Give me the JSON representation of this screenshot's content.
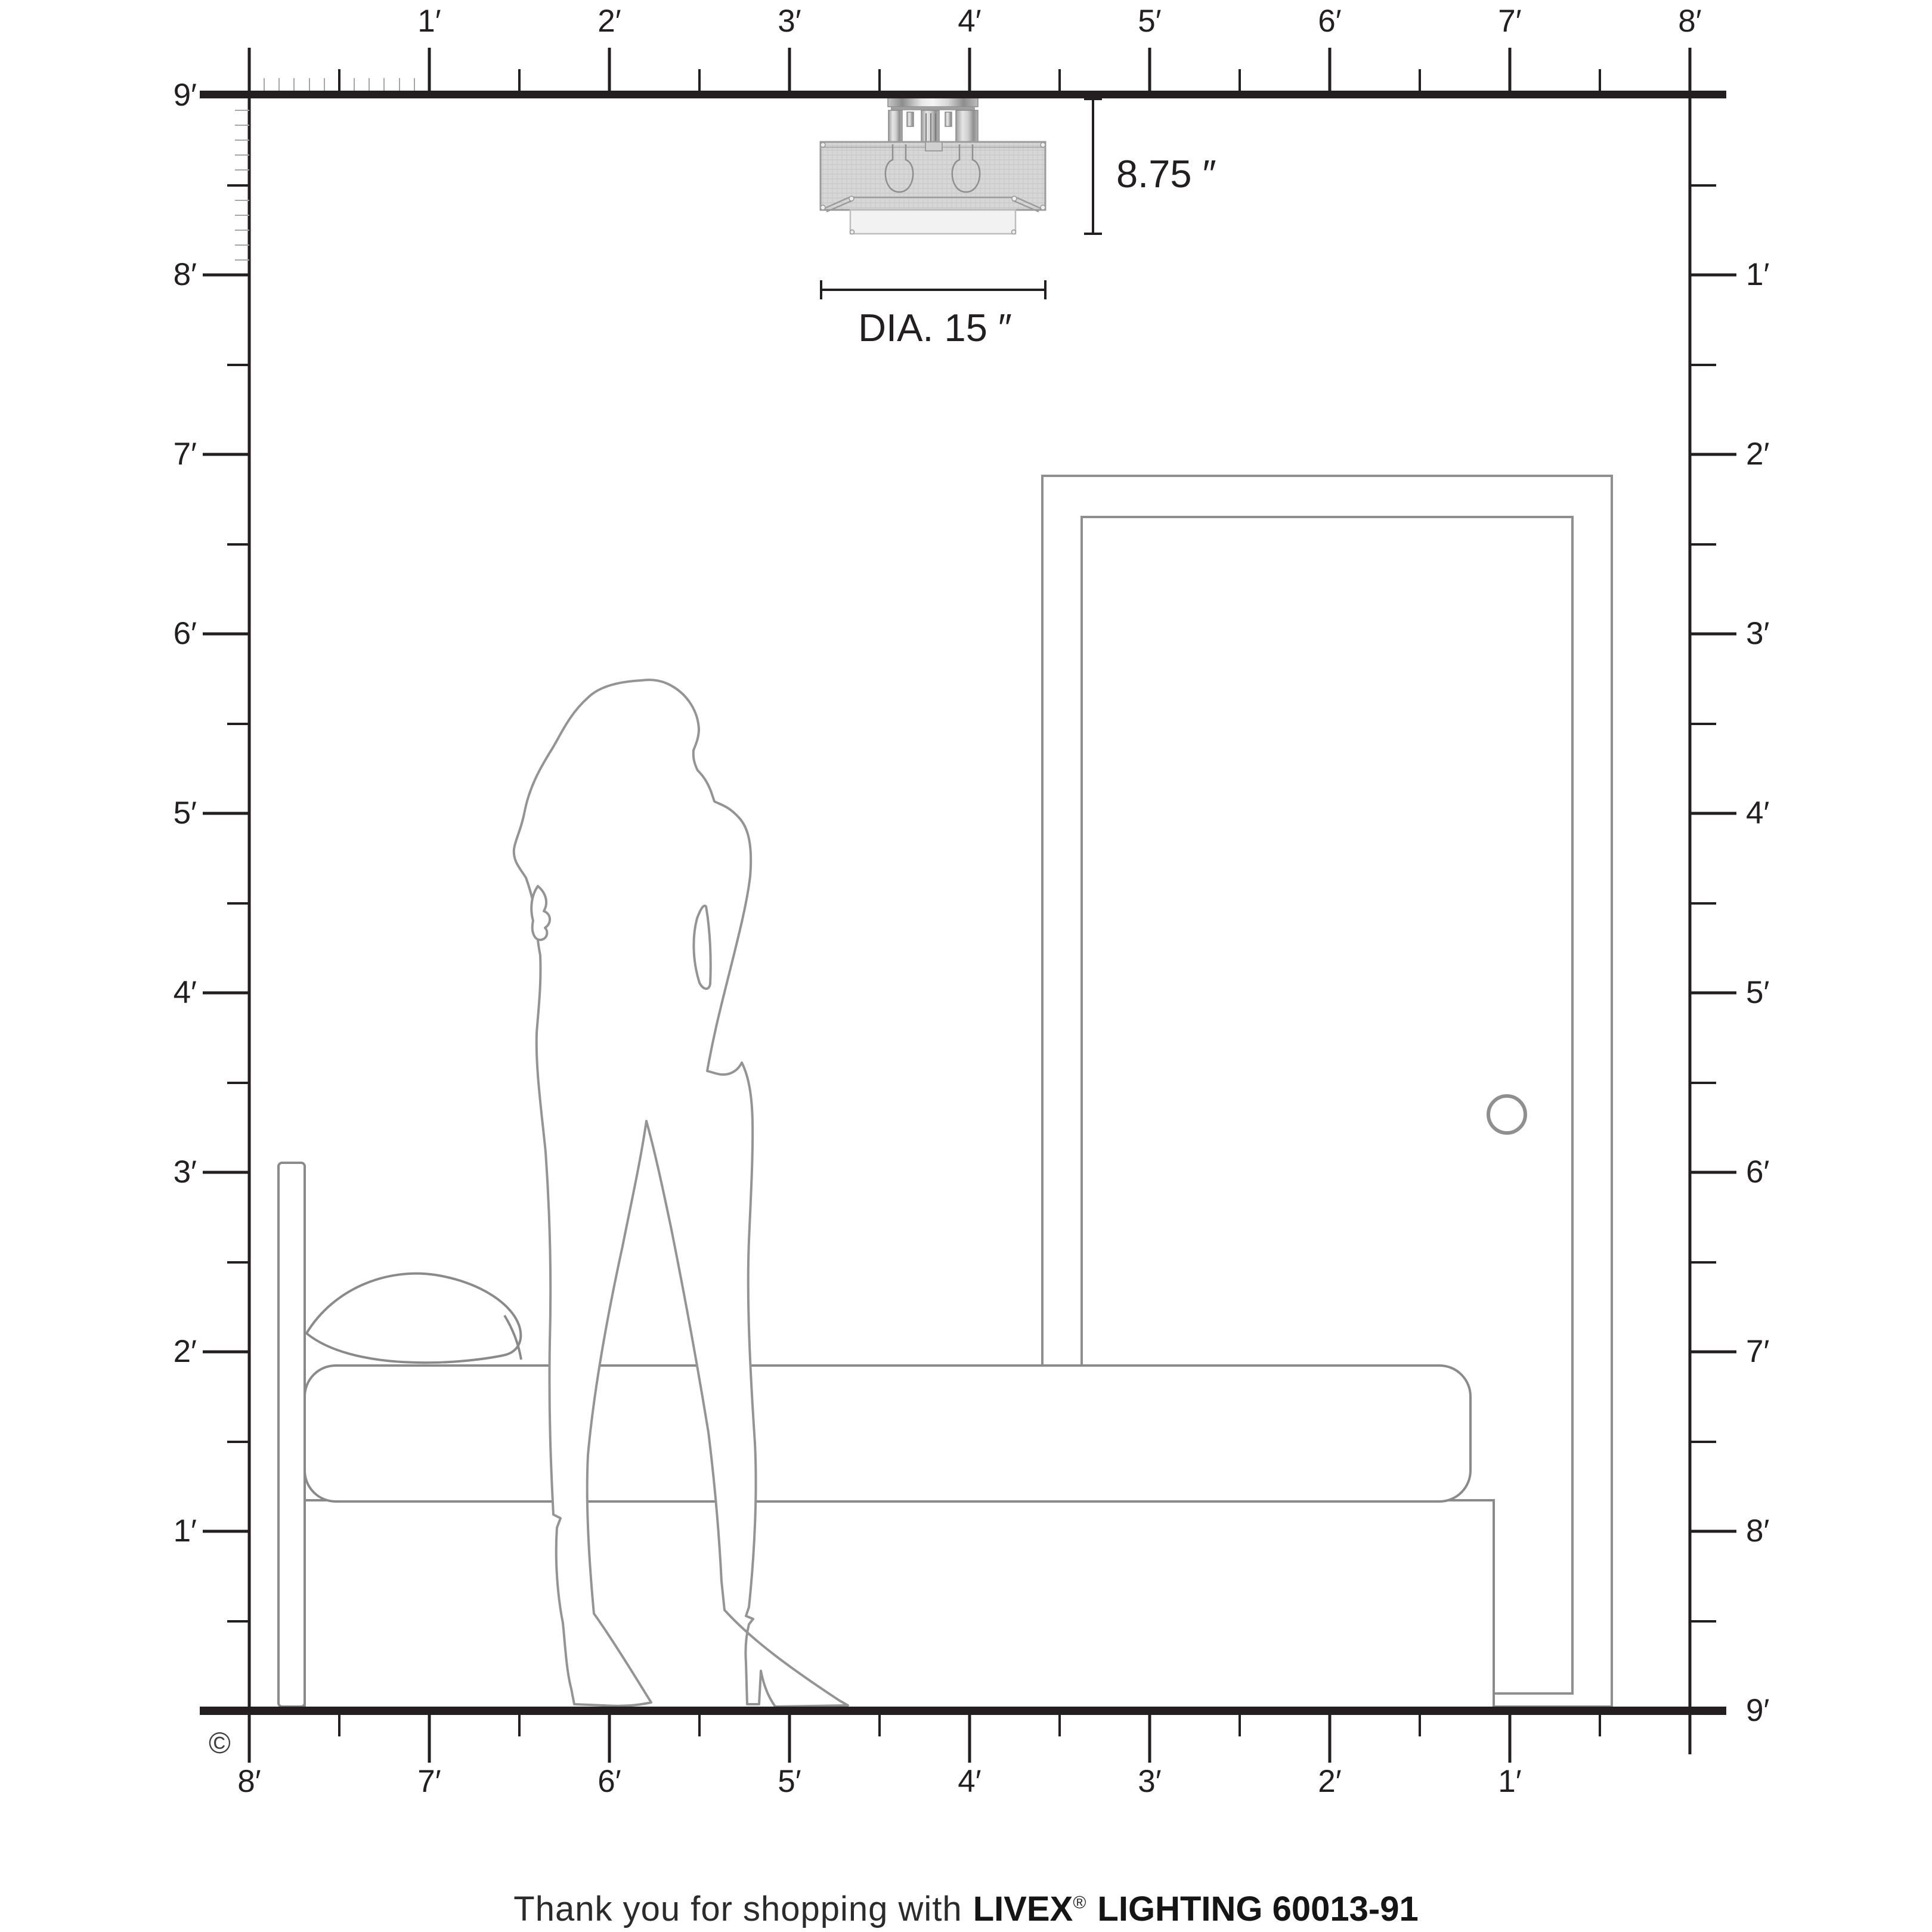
{
  "diagram": {
    "copyright": "©",
    "dimensions": {
      "height_label": "8.75 ″",
      "diameter_label": "DIA. 15 ″"
    }
  },
  "rulers": {
    "top": [
      "1′",
      "2′",
      "3′",
      "4′",
      "5′",
      "6′",
      "7′",
      "8′"
    ],
    "left": [
      "9′",
      "8′",
      "7′",
      "6′",
      "5′",
      "4′",
      "3′",
      "2′",
      "1′"
    ],
    "right": [
      "1′",
      "2′",
      "3′",
      "4′",
      "5′",
      "6′",
      "7′",
      "8′",
      "9′"
    ],
    "bottom": [
      "8′",
      "7′",
      "6′",
      "5′",
      "4′",
      "3′",
      "2′",
      "1′"
    ]
  },
  "footer": {
    "thanks": "Thank you for shopping with",
    "brand": "LIVEX",
    "registered": "®",
    "product": "LIGHTING 60013-91"
  },
  "colors": {
    "line_black": "#231f20",
    "outline_gray": "#8f8f8f",
    "shade_gray": "#d7d7d7",
    "diffuser_gray": "#f0f0f0"
  }
}
